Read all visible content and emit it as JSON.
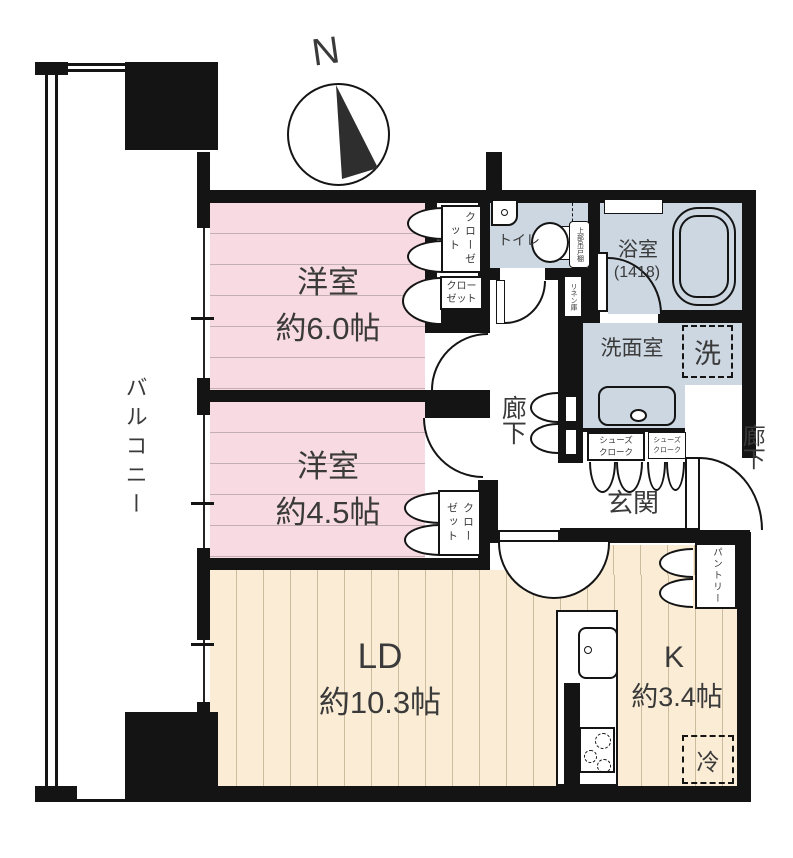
{
  "compass": {
    "letter": "N"
  },
  "balcony": {
    "label": "バルコニー"
  },
  "rooms": {
    "bedroom1": {
      "name": "洋室",
      "size": "約6.0帖"
    },
    "bedroom2": {
      "name": "洋室",
      "size": "約4.5帖"
    },
    "living_dining": {
      "name": "LD",
      "size": "約10.3帖"
    },
    "kitchen": {
      "name": "K",
      "size": "約3.4帖"
    },
    "toilet": {
      "label": "トイレ"
    },
    "bathroom": {
      "name": "浴室",
      "size_note": "(1418)"
    },
    "washroom": {
      "label": "洗面室"
    },
    "entrance": {
      "label": "玄関"
    },
    "hallway_inner": {
      "label": "廊下"
    },
    "hallway_outer": {
      "label": "廊下"
    }
  },
  "storage": {
    "closet_bedroom1_upper": "クローゼット",
    "closet_bedroom1_lower": "クローゼット",
    "closet_bedroom2": "クローゼット",
    "shoe_closet_left": "シューズクローク",
    "shoe_closet_right": "シューズクローク",
    "pantry": "パントリー",
    "linen_cabinet": "リネン庫",
    "upper_cabinet": "上部吊戸棚"
  },
  "appliances": {
    "washing_machine": "洗",
    "refrigerator": "冷"
  },
  "colors": {
    "bedroom_fill": "#f8dbe2",
    "wet_area_fill": "#ccd7e2",
    "ldk_fill": "#faecd5",
    "wall": "#141414"
  }
}
